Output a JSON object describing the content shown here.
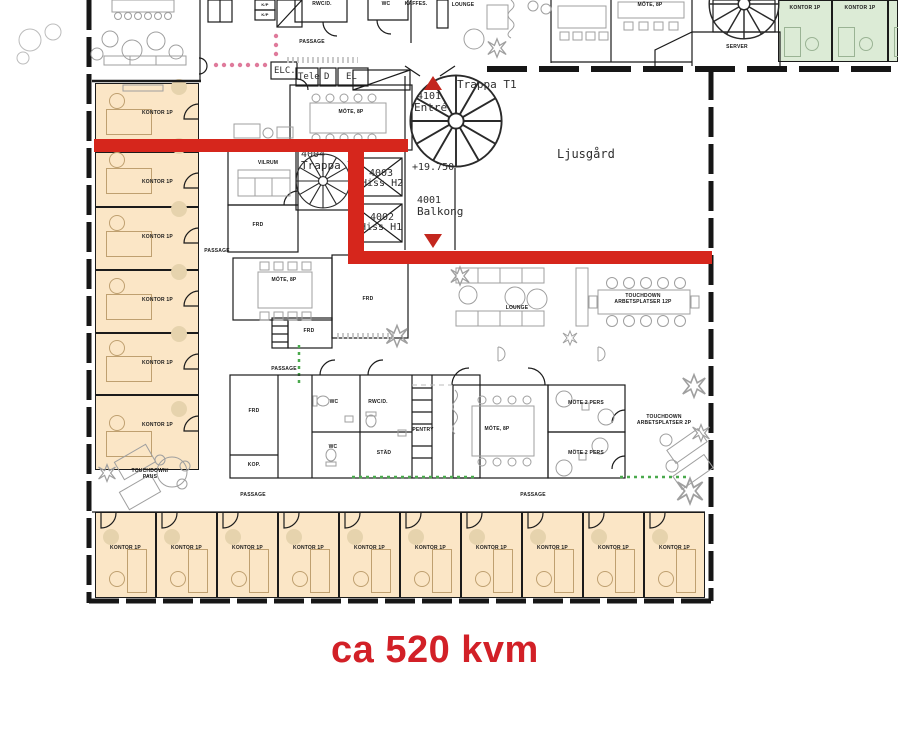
{
  "annotation": {
    "area_text": "ca 520 kvm"
  },
  "colors": {
    "highlight_red": "#d6261c",
    "text_red": "#d22027",
    "office_fill": "#fbe6c6",
    "green_office_fill": "#dcebd6",
    "pink_dot": "#df7a9b",
    "green_marker": "#4aa94d",
    "wall": "#1b1b1b"
  },
  "labels": {
    "elc": "ELC.",
    "tele": "Tele",
    "d": "D",
    "el": "EL",
    "passage": "PASSAGE",
    "rwc": "RWC/D.",
    "wc": "WC",
    "kaffes": "KAFFES.",
    "lounge": "LOUNGE",
    "mote8": "MÖTE, 8P",
    "server": "SERVER",
    "kp": "K/P",
    "trappa_t1": "Trappa T1",
    "entre_no": "4101",
    "entre": "Entré",
    "level": "+19.750",
    "balkong_no": "4001",
    "balkong": "Balkong",
    "hiss_h2_no": "4003",
    "hiss_h2": "Hiss H2",
    "hiss_h1_no": "4002",
    "hiss_h1": "Hiss H1",
    "trappa_t2_no": "4004",
    "trappa_t2": "Trappa T2",
    "ljusgard": "Ljusgård",
    "vilrum": "VILRUM",
    "frd": "FRD",
    "kop": "KOP.",
    "stad": "STÄD",
    "pentry": "PENTRY",
    "mote2": "MÖTE 2 PERS",
    "td12_line1": "TOUCHDOWN",
    "td12_line2": "ARBETSPLATSER 12P",
    "td2_line1": "TOUCHDOWN",
    "td2_line2": "ARBETSPLATSER 2P",
    "tdpaus_line1": "TOUCHDOWN/",
    "tdpaus_line2": "PAUS"
  },
  "offices": {
    "left": [
      "KONTOR 1P",
      "KONTOR 1P",
      "KONTOR 1P",
      "KONTOR 1P",
      "KONTOR 1P",
      "KONTOR 1P"
    ],
    "bottom": [
      "KONTOR 1P",
      "KONTOR 1P",
      "KONTOR 1P",
      "KONTOR 1P",
      "KONTOR 1P",
      "KONTOR 1P",
      "KONTOR 1P",
      "KONTOR 1P",
      "KONTOR 1P",
      "KONTOR 1P"
    ],
    "green": [
      "KONTOR 1P",
      "KONTOR 1P"
    ]
  }
}
